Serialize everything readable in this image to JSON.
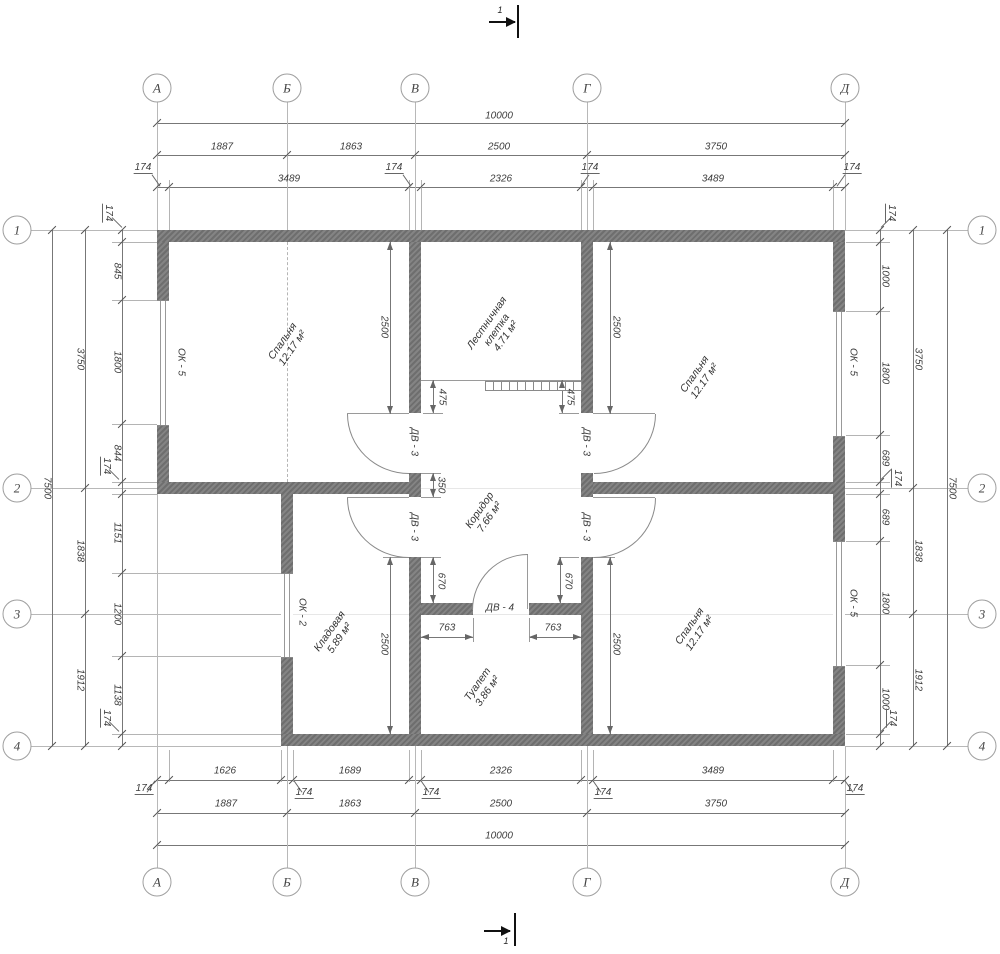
{
  "axes": {
    "columns": [
      "А",
      "Б",
      "В",
      "Г",
      "Д"
    ],
    "rows": [
      "1",
      "2",
      "3",
      "4"
    ]
  },
  "section_marks": {
    "label": "1"
  },
  "dimensions": {
    "top": {
      "total": "10000",
      "spans": [
        "1887",
        "1863",
        "2500",
        "3750"
      ],
      "chain": [
        "174",
        "3489",
        "174",
        "2326",
        "174",
        "3489",
        "174"
      ]
    },
    "bottom": {
      "total": "10000",
      "spans": [
        "1887",
        "1863",
        "2500",
        "3750"
      ],
      "chain": [
        "174",
        "1626",
        "174",
        "1689",
        "174",
        "2326",
        "174",
        "3489",
        "174"
      ]
    },
    "left": {
      "total": "7500",
      "spans": [
        "3750",
        "1838",
        "1912"
      ],
      "chain": [
        "174",
        "845",
        "1800",
        "844",
        "174",
        "1151",
        "1200",
        "1138",
        "174"
      ]
    },
    "right": {
      "total": "7500",
      "spans": [
        "3750",
        "1838",
        "1912"
      ],
      "chain": [
        "174",
        "1000",
        "1800",
        "689",
        "174",
        "689",
        "1800",
        "1000",
        "174"
      ]
    },
    "interior": {
      "bedroom_tl": "2500",
      "bedroom_tr": "2500",
      "storage": "2500",
      "bedroom_br": "2500",
      "stair_left": "475",
      "stair_right": "475",
      "partition": "350",
      "corridor_left": "670",
      "corridor_right": "670",
      "toilet_left": "763",
      "toilet_right": "763"
    }
  },
  "rooms": [
    {
      "name": "Спальня",
      "area": "12.17 м²"
    },
    {
      "name": "Лестничная клетка",
      "area": "4.71 м²"
    },
    {
      "name": "Спальня",
      "area": "12.17 м²"
    },
    {
      "name": "Коридор",
      "area": "7.66 м²"
    },
    {
      "name": "Кладовая",
      "area": "5.89 м²"
    },
    {
      "name": "Туалет",
      "area": "3.86 м²"
    },
    {
      "name": "Спальня",
      "area": "12.17 м²"
    }
  ],
  "openings": {
    "window_type_5": "ОК - 5",
    "window_type_2": "ОК - 2",
    "door_type_3": "ДВ - 3",
    "door_type_4": "ДВ - 4"
  },
  "colors": {
    "wall_fill": "#767676",
    "line": "#8c8c8c",
    "dimension_line": "#777777",
    "grid_line": "#b8b8b8",
    "text": "#3c3c3c",
    "background": "#ffffff",
    "section_mark": "#111111"
  }
}
